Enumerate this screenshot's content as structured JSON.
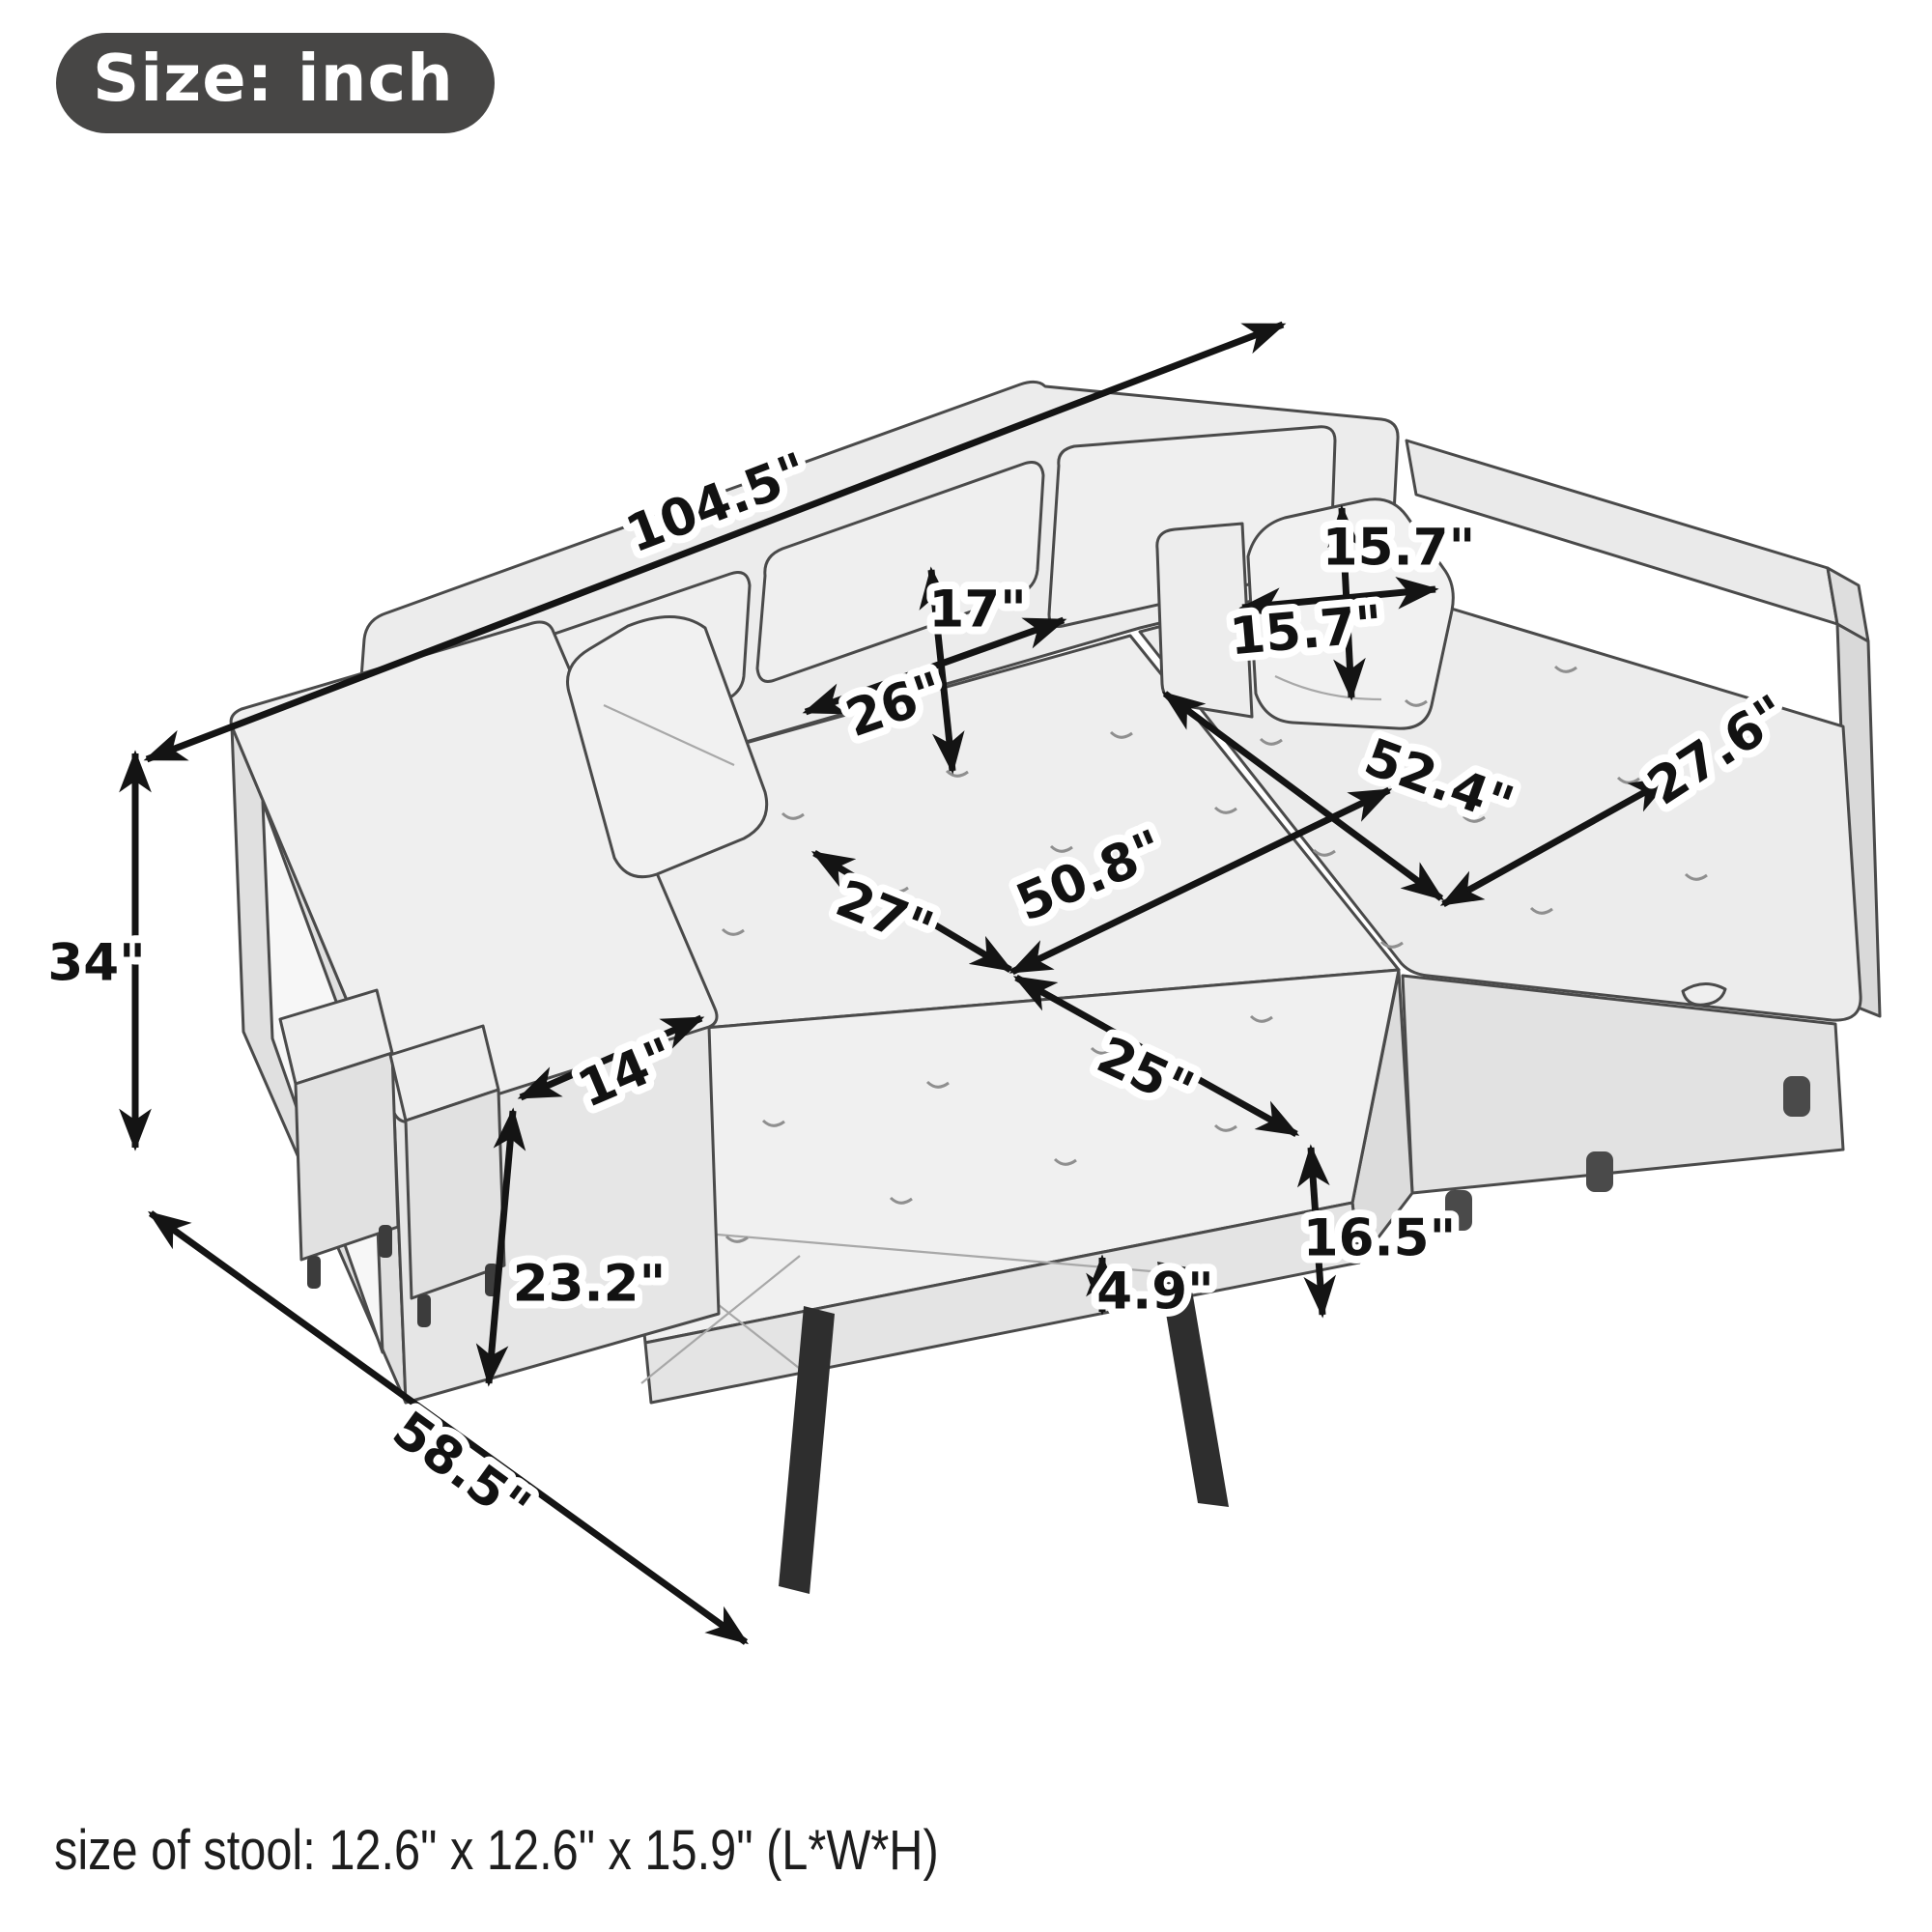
{
  "badge": {
    "label": "Size: inch"
  },
  "footnote": "size of stool: 12.6\" x 12.6\" x 15.9\" (L*W*H)",
  "unit": "inch",
  "dimensions": {
    "overall_length": {
      "value": 104.5,
      "label": "104.5\""
    },
    "overall_height": {
      "value": 34,
      "label": "34\""
    },
    "overall_depth": {
      "value": 58.5,
      "label": "58.5\""
    },
    "back_cushion_height": {
      "value": 17,
      "label": "17\""
    },
    "back_cushion_width": {
      "value": 26,
      "label": "26\""
    },
    "pillow_height": {
      "value": 15.7,
      "label": "15.7\""
    },
    "pillow_width": {
      "value": 15.7,
      "label": "15.7\""
    },
    "chaise_length": {
      "value": 52.4,
      "label": "52.4\""
    },
    "chaise_width": {
      "value": 27.6,
      "label": "27.6\""
    },
    "seat_depth": {
      "value": 27,
      "label": "27\""
    },
    "bed_length": {
      "value": 50.8,
      "label": "50.8\""
    },
    "bed_width": {
      "value": 25,
      "label": "25\""
    },
    "arm_width": {
      "value": 14,
      "label": "14\""
    },
    "arm_front_height": {
      "value": 23.2,
      "label": "23.2\""
    },
    "bed_height": {
      "value": 16.5,
      "label": "16.5\""
    },
    "mattress_thickness": {
      "value": 4.9,
      "label": "4.9\""
    },
    "stool": {
      "length": 12.6,
      "width": 12.6,
      "height": 15.9
    }
  }
}
